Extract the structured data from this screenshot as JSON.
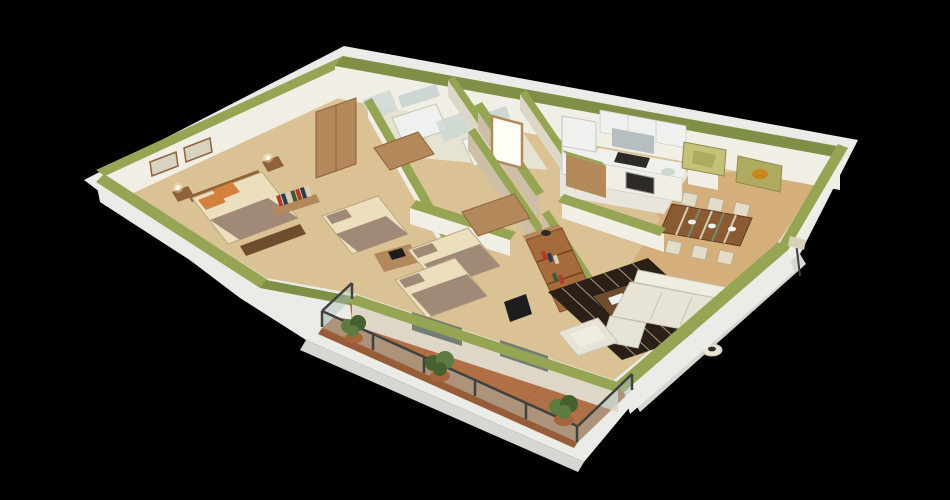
{
  "scene": {
    "kind": "3d-floorplan-cutaway-render",
    "view": "isometric aerial cutaway of an apartment",
    "background_note": "rendered model on plain black background"
  },
  "colors": {
    "background": "#000000",
    "oliveTop": "#96a553",
    "oliveTopDark": "#7f8f45",
    "wallLit": "#f1eee5",
    "wallShaded": "#ded7c7",
    "wallBeige": "#cdbfa6",
    "slab": "#ebebe7",
    "slabEdge": "#d7d7d2",
    "floorWood": "#dac294",
    "floorWoodWarm": "#d3ab77",
    "bathFloor": "#e6e3d2",
    "kitchenFloor": "#e8e6dc",
    "balconyTile": "#b06f45",
    "balconyTileDark": "#975c38",
    "woodFurniture": "#b3885a",
    "woodDark": "#8f6238",
    "shelfWood": "#a66b3b",
    "bedCream": "#ecdfbe",
    "bedMauve": "#a18977",
    "pillowOrange": "#d4813d",
    "benchBrown": "#6e4c2e",
    "rugDark": "#2b2017",
    "rugStripe": "#c7b695",
    "sofaCream": "#e7e3d5",
    "sofaBack": "#efece2",
    "applianceWhite": "#eff1ef",
    "steel": "#b6bec2",
    "darkAppliance": "#2e2a26",
    "tableWood": "#8a5a33",
    "chairCream": "#e3dcc8",
    "glassRail": "rgba(170,190,184,0.45)",
    "railMetal": "#3d423f",
    "glassDark": "#5f6e66",
    "doorGlow": "#fffef7",
    "frameWood": "#b08a58",
    "plantGreen": "#5d7d40",
    "plantGreenDark": "#46612f",
    "potTerracotta": "#a4643c",
    "paintingOlive": "#c5c178",
    "paintingOlive2": "#aeab60",
    "paintingAccent": "#c8861f",
    "mirrorBlue": "#ccd7d2",
    "artPaper": "#d8d2c0",
    "bookRed": "#b23a2a",
    "bookBlue": "#2e3a55",
    "bookCream": "#d8cfb8",
    "bookGreen": "#3f5a33",
    "lampLight": "#fff7dd",
    "tvBlack": "#1d1d1d"
  },
  "rooms": [
    {
      "id": "master-bedroom",
      "furnishings": [
        "double bed with orange pillows",
        "wardrobe",
        "two nightstands with lamps",
        "foot bench",
        "two wall pictures",
        "wall book shelf"
      ]
    },
    {
      "id": "bathroom-1",
      "furnishings": [
        "vanity counter",
        "mirror",
        "shower"
      ]
    },
    {
      "id": "bathroom-2",
      "furnishings": [
        "vanity counter",
        "mirror",
        "shower"
      ]
    },
    {
      "id": "entrance-hall",
      "furnishings": [
        "glowing entry door"
      ]
    },
    {
      "id": "kitchen",
      "furnishings": [
        "fridge",
        "upper cabinets",
        "range hood",
        "cooktop",
        "oven",
        "sink",
        "counter"
      ]
    },
    {
      "id": "dining-room",
      "furnishings": [
        "wood dining table with striped runner",
        "six chairs",
        "two olive abstract paintings",
        "floor lamp"
      ]
    },
    {
      "id": "bedroom-2",
      "furnishings": [
        "single bed",
        "desk with laptop",
        "wardrobe"
      ]
    },
    {
      "id": "bedroom-3",
      "furnishings": [
        "two single beds",
        "wardrobe"
      ]
    },
    {
      "id": "living-room",
      "furnishings": [
        "white L sofa",
        "armchair",
        "dark striped rug",
        "coffee table",
        "tall bookshelf",
        "tv panel",
        "round side table"
      ]
    },
    {
      "id": "balcony",
      "furnishings": [
        "terracotta tile floor",
        "metal and glass railing",
        "three potted plants"
      ]
    }
  ]
}
